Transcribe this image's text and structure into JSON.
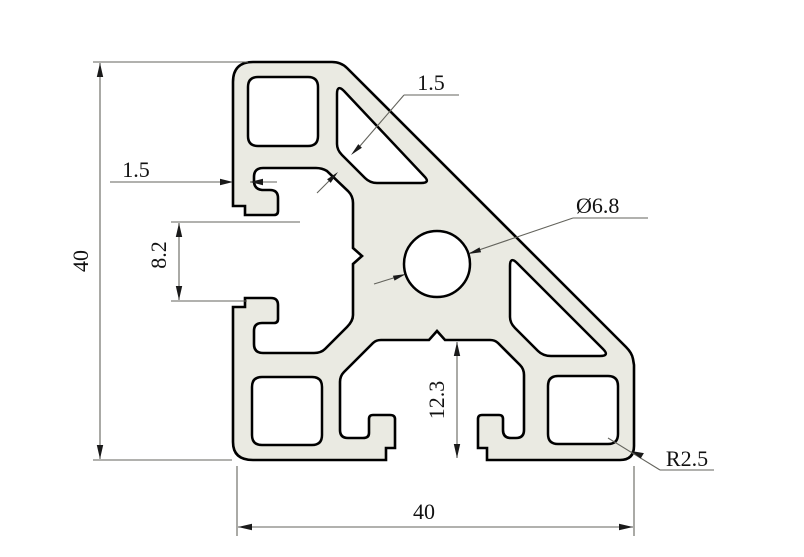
{
  "drawing": {
    "title": "Aluminium extrusion profile cross-section, 40x40 45-degree angle profile",
    "labels": {
      "overall_height": "40",
      "overall_width": "40",
      "left_wall_thickness": "1.5",
      "diagonal_wall_thickness": "1.5",
      "left_slot_opening": "8.2",
      "bottom_slot_depth": "12.3",
      "center_bore_diameter": "Ø6.8",
      "corner_radius": "R2.5"
    },
    "colors": {
      "background": "#ffffff",
      "profile_fill": "#eaeae2",
      "profile_outline": "#000000",
      "dimension_line": "#63635c",
      "text": "#111111"
    }
  }
}
